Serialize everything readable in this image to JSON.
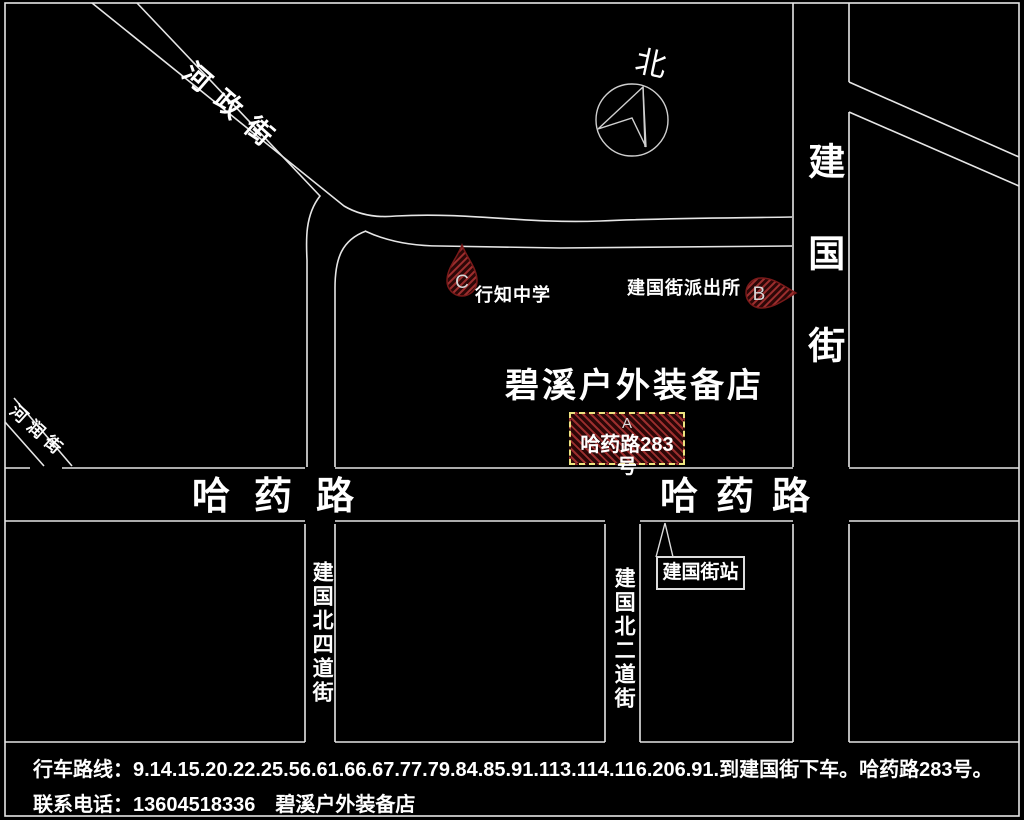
{
  "map": {
    "compass_label": "北",
    "streets": {
      "northwest_diagonal": "河政街",
      "southwest_diagonal": "河润街",
      "jianguo_street": "建国街",
      "hayao_road_west": "哈药路",
      "hayao_road_east": "哈药路",
      "jianguo_north_4th": "建国北四道街",
      "jianguo_north_2nd": "建国北二道街"
    },
    "pois": {
      "store_title": "碧溪户外装备店",
      "store_marker_letter": "A",
      "store_address": "哈药路283号",
      "police_station": "建国街派出所",
      "police_marker_letter": "B",
      "school": "行知中学",
      "school_marker_letter": "C",
      "bus_stop": "建国街站"
    }
  },
  "footer": {
    "route_line": "行车路线：9.14.15.20.22.25.56.61.66.67.77.79.84.85.91.113.114.116.206.91.到建国街下车。哈药路283号。",
    "phone_line": "联系电话：13604518336　碧溪户外装备店"
  },
  "colors": {
    "background": "#000000",
    "road_line": "#e6e6e6",
    "marker_dark": "#2c0707",
    "marker_hatch": "#9c2e2e",
    "store_box_border": "#ece47f",
    "text": "#ffffff"
  }
}
